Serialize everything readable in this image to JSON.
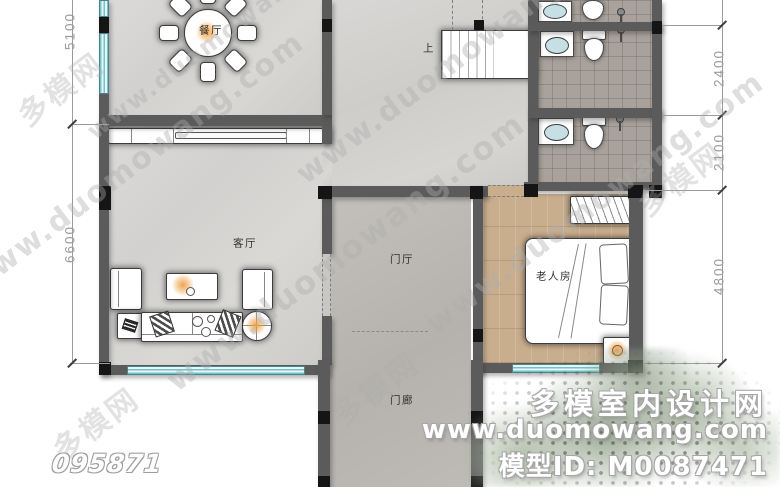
{
  "plan": {
    "rooms": [
      {
        "id": "dining",
        "label": "餐厅"
      },
      {
        "id": "living",
        "label": "客厅"
      },
      {
        "id": "foyer",
        "label": "门厅"
      },
      {
        "id": "porch",
        "label": "门廊"
      },
      {
        "id": "elderly",
        "label": "老人房"
      }
    ],
    "stairs_label": "上"
  },
  "dimensions": {
    "left": [
      "5100",
      "6600"
    ],
    "right": [
      "2400",
      "2100",
      "4800"
    ]
  },
  "watermark": {
    "url": "www.duomowang.com",
    "stamp": "多模网"
  },
  "branding": {
    "site_name": "多模室内设计网",
    "site_url": "www.duomowang.com",
    "model_id": "模型ID: M0087471"
  },
  "plan_id": "095871",
  "colors": {
    "wall": "#5b5b5b",
    "column": "#151515",
    "window": "#6fc3c9",
    "marble_floor": "#d6d5d3",
    "concrete_floor": "#bcb9b5",
    "wood_floor": "#c9ae8e",
    "tile_floor": "#a9a29c",
    "lamp_glow": "#ee a040"
  }
}
